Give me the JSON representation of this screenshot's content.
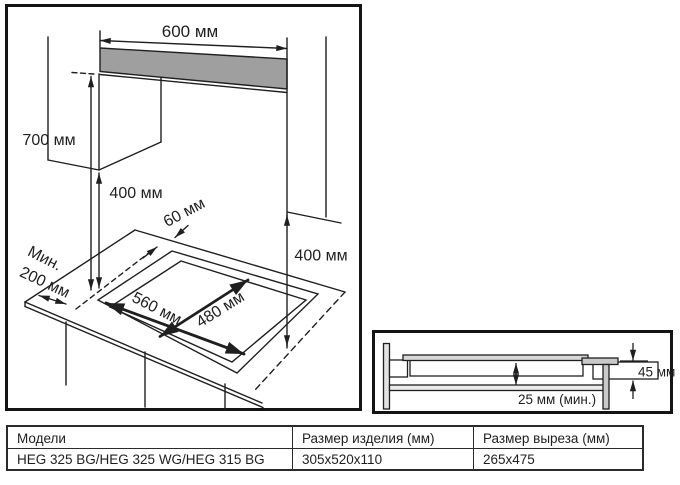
{
  "left_diagram": {
    "title_semantic": "hob installation clearances drawing",
    "labels": {
      "hood_width": "600 мм",
      "hood_clearance": "700 мм",
      "cabinet_clearance_left": "400 мм",
      "rear_gap": "60 мм",
      "side_min_line1": "Мин.",
      "side_min_line2": "200 мм",
      "cutout_width": "560 мм",
      "cutout_depth": "480 мм",
      "cabinet_clearance_right": "400 мм"
    }
  },
  "section_diagram": {
    "title_semantic": "worktop cross-section of built-in hob",
    "labels": {
      "built_in_height": "45 мм",
      "bottom_clearance": "25 мм (мин.)"
    }
  },
  "table": {
    "headers": [
      "Модели",
      "Размер изделия (мм)",
      "Размер выреза (мм)"
    ],
    "rows": [
      [
        "HEG 325 BG/HEG 325 WG/HEG 315 BG",
        "305x520x110",
        "265x475"
      ]
    ]
  },
  "colors": {
    "line": "#1f1f1f",
    "hood_fill": "#9f9f9f",
    "glass_fill": "#d8d8d8",
    "bracket_fill": "#c9c9c9",
    "wall_fill": "#e2e2e2",
    "shelf_fill": "#ebebeb"
  }
}
